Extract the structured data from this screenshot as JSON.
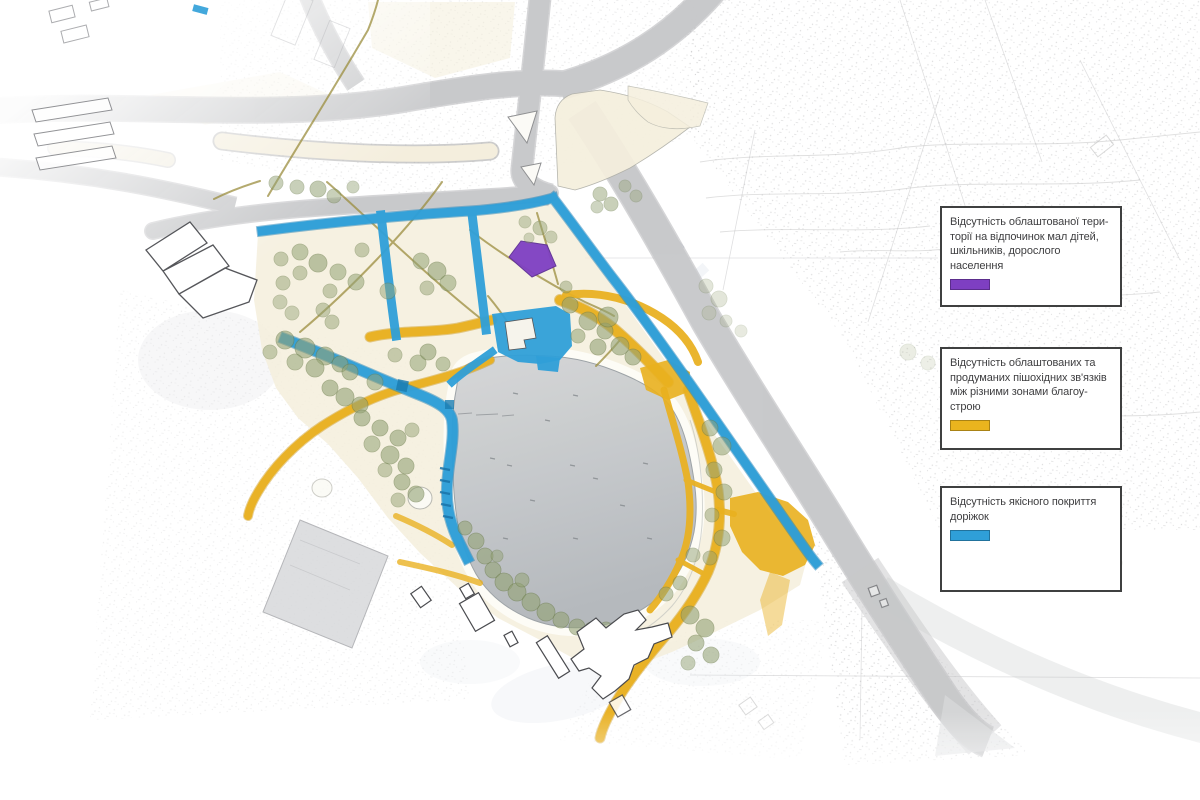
{
  "map": {
    "kind": "landscape-site-plan",
    "language": "uk",
    "legend": {
      "items": [
        {
          "key": "recreation-areas-missing",
          "color": "#7e3fc2",
          "lines": [
            "Відсутність облаштованої тери-",
            "торії на відпочинок мал дітей,",
            "шкільників, дорослого населення"
          ]
        },
        {
          "key": "pedestrian-links-missing",
          "color": "#eab41e",
          "lines": [
            "Відсутність облаштованих та",
            "продуманих пішохідних зв'язків",
            "між різними зонами благоу-",
            "строю"
          ]
        },
        {
          "key": "path-surfacing-missing",
          "color": "#2f9fd8",
          "lines": [
            "Відсутність якісного покриття",
            "доріжок"
          ]
        }
      ]
    },
    "feature_colors": {
      "road": "#c6c7c9",
      "lake": "#c2c5c8",
      "park_base": "#f4eeda",
      "tree": "#93a275",
      "blue_path": "#2f9fd8",
      "yellow_path": "#e9b01f",
      "purple_area": "#7e3fc2"
    }
  }
}
